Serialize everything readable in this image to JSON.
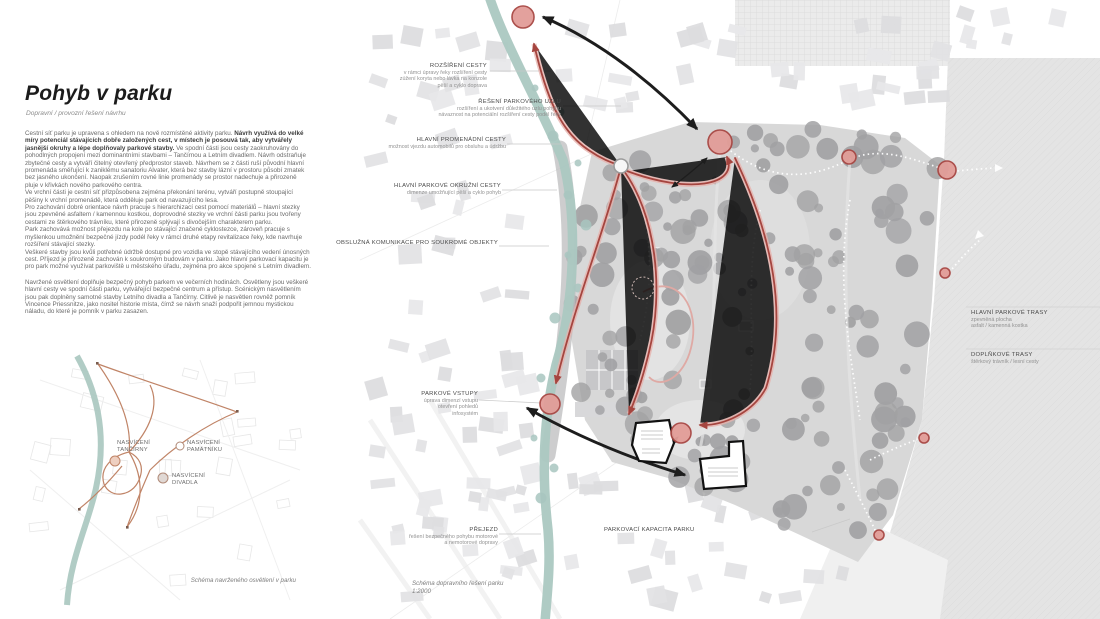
{
  "colors": {
    "river": "#abc8c1",
    "route_red": "#a5453f",
    "route_halo": "#e7b3ae",
    "entrance_node_fill": "#e29d98",
    "lighting_path": "#c08467",
    "arrow_ink": "#1d1d1d"
  },
  "header": {
    "title": "Pohyb v parku",
    "subtitle": "Dopravní / provozní řešení návrhu"
  },
  "article": {
    "p1_lead": "Cestní síť parku je upravena s ohledem na nově rozmístěné aktivity parku. ",
    "p1_bold": "Návrh využívá do velké míry potenciál stávajících dobře založených cest, v místech je posouvá tak, aby vytvářely jasnější okruhy a lépe doplňovaly parkové stavby.",
    "p1_rest": " Ve spodní části jsou cesty zaokruhovány do pohodlných propojení mezi dominantními stavbami – Tančírnou a Letním divadlem. Návrh odstraňuje zbytečné cesty a vytváří čitelný otevřený předprostor staveb. Návrhem se z části ruší původní hlavní promenáda směřující k zaniklému sanatoriu Alvater, která bez stavby lázní v prostoru působí zmatek bez jasného ukončení. Naopak zrušením rovné linie promenády se prostor nadechuje a přirozeně pluje v křivkách nového parkového centra.",
    "p2": "Ve vrchní části je cestní síť přizpůsobena zejména překonání terénu, vytváří postupně stoupající pěšiny k vrchní promenádě, která odděluje park od navazujícího lesa.",
    "p3": "Pro zachování dobré orientace návrh pracuje s hierarchizací cest pomocí materiálů – hlavní stezky jsou zpevněné asfaltem / kamennou kostkou, doprovodné stezky ve vrchní části parku jsou tvořeny cestami ze štěrkového trávníku, které přirozeně splývají s divočejším charakterem parku.",
    "p4": "Park zachovává možnost přejezdu na kole po stávající značené cyklostezce, zároveň pracuje s myšlenkou umožnění bezpečné jízdy podél řeky v rámci druhé etapy revitalizace řeky, kde navrhuje rozšíření stávající stezky.",
    "p5": "Veškeré stavby jsou kvůli potřebné údržbě dostupné pro vozidla ve stopě stávajícího vedení únosných cest. Příjezd je přirozeně zachován k soukromým budovám v parku. Jako hlavní parkovací kapacitu je pro park možné využívat parkoviště u městského úřadu, zejména pro akce spojené s Letním divadlem.",
    "p6": "Navržené osvětlení doplňuje bezpečný pohyb parkem ve večerních hodinách. Osvětleny jsou veškeré hlavní cesty ve spodní části parku, vytvářející bezpečné centrum a přístup. Scénickým nasvětlením jsou pak doplněny samotné stavby Letního divadla a Tančírny. Citlivě je nasvětlen rovněž pomník Vincence Priessnitze, jako nositel historie místa, čímž se návrh snaží podpořit jemnou mystickou náladu, do které je pomník v parku zasazen."
  },
  "lighting_diagram": {
    "labels": [
      {
        "l1": "NASVÍCENÍ",
        "l2": "TANČÍRNY"
      },
      {
        "l1": "NASVÍCENÍ",
        "l2": "PAMÁTNÍKU"
      },
      {
        "l1": "NASVÍCENÍ",
        "l2": "DIVADLA"
      }
    ],
    "caption": "Schéma navrženého osvětlení v parku"
  },
  "map": {
    "annotations": [
      {
        "title": "ROZŠÍŘENÍ CESTY",
        "lines": [
          "v rámci úpravy řeky rozšíření cesty",
          "zúžení koryta nebo lávka na konzole",
          "pěší a cyklo doprava"
        ]
      },
      {
        "title": "ŘEŠENÍ PARKOVÉHO UZLU",
        "lines": [
          "rozšíření a ukotvení důležitého uzlu pohybu",
          "návaznost na potenciální rozšíření cesty podél řeky"
        ]
      },
      {
        "title": "HLAVNÍ PROMENÁDNÍ CESTY",
        "lines": [
          "možnost vjezdu automobilů pro obsluhu a údržbu"
        ]
      },
      {
        "title": "HLAVNÍ PARKOVÉ OKRUŽNÍ CESTY",
        "lines": [
          "dimenze umožňující pěší a cyklo pohyb"
        ]
      },
      {
        "title": "OBSLUŽNÁ KOMUNIKACE PRO SOUKROMÉ OBJEKTY",
        "lines": []
      },
      {
        "title": "PARKOVÉ VSTUPY",
        "lines": [
          "úprava dimenzí vstupu",
          "otevření pohledů",
          "infosystém"
        ]
      },
      {
        "title": "PŘEJEZD",
        "lines": [
          "řešení bezpečného pohybu motorové",
          "a nemotorové dopravy"
        ]
      },
      {
        "title": "PARKOVACÍ KAPACITA PARKU",
        "lines": []
      }
    ],
    "legend": [
      {
        "title": "HLAVNÍ PARKOVÉ TRASY",
        "lines": [
          "zpevněná plocha",
          "asfalt / kamenná kostka"
        ]
      },
      {
        "title": "DOPLŇKOVÉ TRASY",
        "lines": [
          "štěrkový trávník / lesní cesty"
        ]
      }
    ],
    "caption_line1": "Schéma dopravního řešení parku",
    "caption_line2": "1:2000"
  }
}
